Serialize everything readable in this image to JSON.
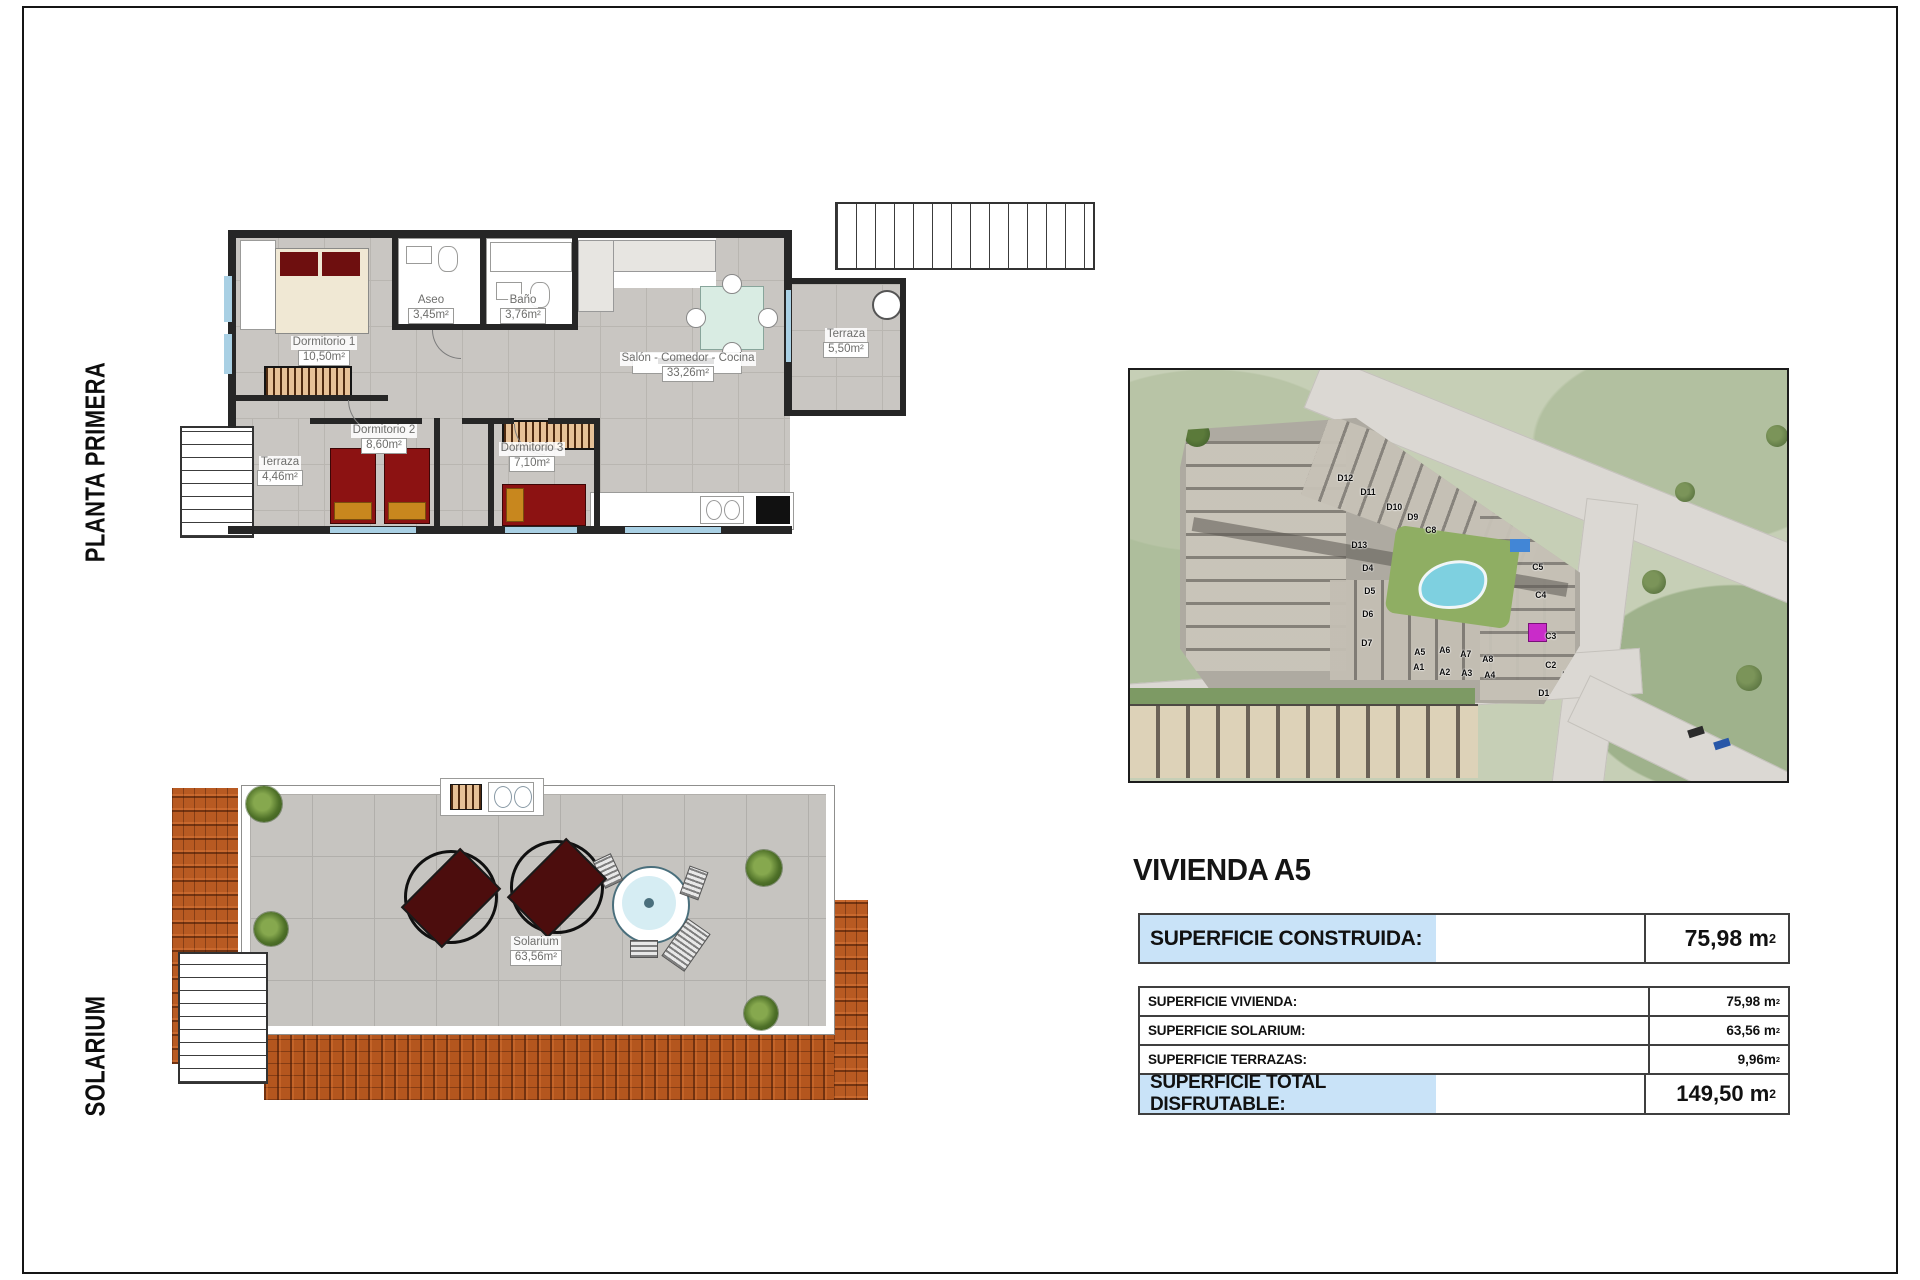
{
  "sidebar": {
    "floor_label": "PLANTA PRIMERA",
    "solarium_label": "SOLARIUM"
  },
  "floorplan": {
    "rooms": [
      {
        "name": "Dormitorio 1",
        "area": "10,50m²"
      },
      {
        "name": "Aseo",
        "area": "3,45m²"
      },
      {
        "name": "Baño",
        "area": "3,76m²"
      },
      {
        "name": "Salón - Comedor - Cocina",
        "area": "33,26m²"
      },
      {
        "name": "Dormitorio 2",
        "area": "8,60m²"
      },
      {
        "name": "Dormitorio 3",
        "area": "7,10m²"
      },
      {
        "name": "Terraza",
        "area": "4,46m²"
      },
      {
        "name": "Terraza",
        "area": "5,50m²"
      }
    ]
  },
  "solarium": {
    "room": {
      "name": "Solarium",
      "area": "63,56m²"
    }
  },
  "sitemap": {
    "units": [
      "D12",
      "D11",
      "D10",
      "D9",
      "C8",
      "D13",
      "D4",
      "D5",
      "D6",
      "D7",
      "A5",
      "A6",
      "A7",
      "A8",
      "A1",
      "A2",
      "A3",
      "A4",
      "C5",
      "C4",
      "C3",
      "C2",
      "D1",
      "D2"
    ]
  },
  "panel": {
    "title": "VIVIENDA A5",
    "construida": {
      "label": "SUPERFICIE CONSTRUIDA:",
      "value": "75,98 m",
      "sup": "2"
    },
    "rows": [
      {
        "label": "SUPERFICIE VIVIENDA:",
        "value": "75,98 m",
        "sup": "2"
      },
      {
        "label": "SUPERFICIE SOLARIUM:",
        "value": "63,56 m",
        "sup": "2"
      },
      {
        "label": "SUPERFICIE TERRAZAS:",
        "value": "9,96m",
        "sup": "2"
      }
    ],
    "total": {
      "label": "SUPERFICIE TOTAL DISFRUTABLE:",
      "value": "149,50 m",
      "sup": "2"
    }
  },
  "colors": {
    "highlight_blue": "#c9e3f8",
    "roof_terracotta": "#b4581f",
    "bed_red": "#8c1212",
    "pool_blue": "#7ed0e0"
  }
}
